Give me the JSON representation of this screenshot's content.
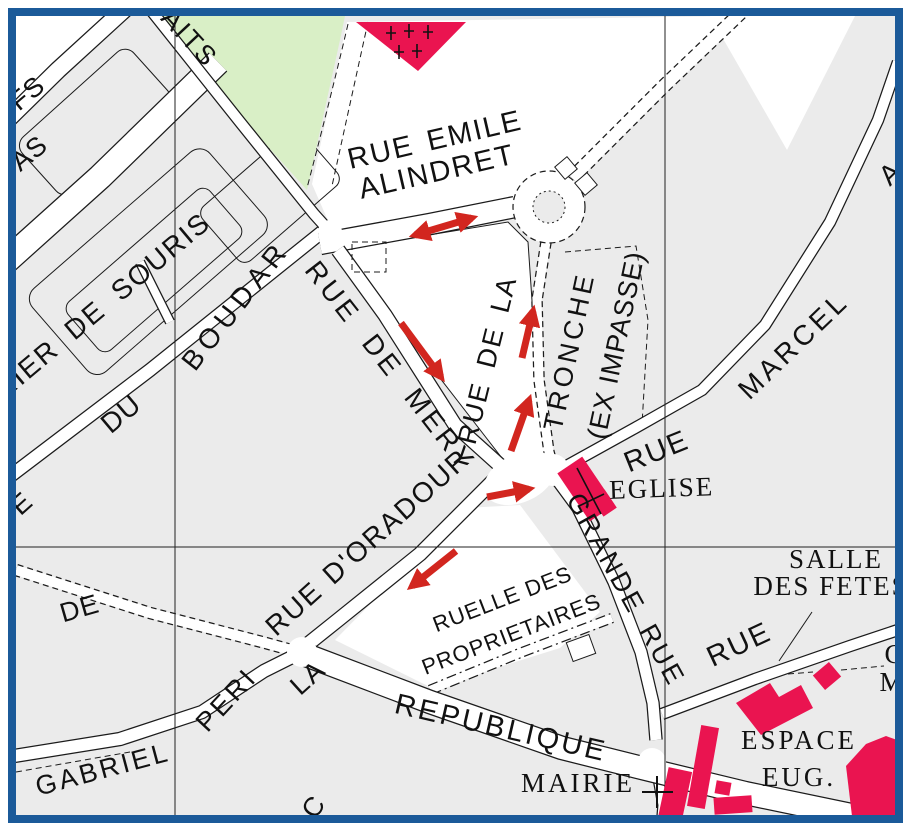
{
  "map": {
    "title": "street map extract with red circulation arrows",
    "canvas": {
      "width": 915,
      "height": 835
    },
    "colors": {
      "border": "#1b5a99",
      "margin": "#ffffff",
      "parcel": "#ebebeb",
      "road": "#ffffff",
      "line": "#1b1b1b",
      "green": "#d9efc6",
      "building": "#ea1450",
      "arrow": "#d2261f",
      "grid": "#222222",
      "text": "#111111"
    },
    "labels": [
      {
        "id": "fragment-aits",
        "text": "AITS",
        "x": 183,
        "y": 44,
        "r": 47,
        "s": 27,
        "ls": 2
      },
      {
        "id": "fragment-fs",
        "text": "FS",
        "x": 33,
        "y": 100,
        "r": -40,
        "s": 27,
        "ls": 1
      },
      {
        "id": "fragment-as",
        "text": "AS",
        "x": 35,
        "y": 160,
        "r": -40,
        "s": 27,
        "ls": 1
      },
      {
        "id": "rue-emile",
        "text": "RUE EMILE",
        "x": 437,
        "y": 149,
        "r": -13,
        "s": 29,
        "ls": 2,
        "ws": 4
      },
      {
        "id": "alindret",
        "text": "ALINDRET",
        "x": 439,
        "y": 181,
        "r": -13,
        "s": 29,
        "ls": 2
      },
      {
        "id": "rier-de-souris",
        "text": "RIER DE SOURIS",
        "x": 108,
        "y": 313,
        "r": -40,
        "s": 28,
        "ls": 2,
        "ws": 8
      },
      {
        "id": "du",
        "text": "DU",
        "x": 127,
        "y": 421,
        "r": -40,
        "s": 28,
        "ls": 1
      },
      {
        "id": "boudar",
        "text": "BOUDAR",
        "x": 243,
        "y": 311,
        "r": -52,
        "s": 28,
        "ls": 6
      },
      {
        "id": "rue-de-mery",
        "text": "RUE DE MERY",
        "x": 383,
        "y": 372,
        "r": 52,
        "s": 28,
        "ls": 4,
        "ws": 10
      },
      {
        "id": "rue-de-la",
        "text": "RUE DE LA",
        "x": 496,
        "y": 362,
        "r": -76,
        "s": 27,
        "ls": 2,
        "ws": 6
      },
      {
        "id": "tronche",
        "text": "TRONCHE",
        "x": 578,
        "y": 353,
        "r": -78,
        "s": 27,
        "ls": 4
      },
      {
        "id": "ex-impasse",
        "text": "(EX IMPASSE)",
        "x": 625,
        "y": 347,
        "r": -78,
        "s": 27,
        "ls": 1
      },
      {
        "id": "marcel",
        "text": "MARCEL",
        "x": 800,
        "y": 352,
        "r": -44,
        "s": 28,
        "ls": 4
      },
      {
        "id": "fragment-a",
        "text": "A",
        "x": 897,
        "y": 180,
        "r": -44,
        "s": 28,
        "ls": 1
      },
      {
        "id": "rue-marcel",
        "text": "RUE",
        "x": 660,
        "y": 460,
        "r": -22,
        "s": 29,
        "ls": 2
      },
      {
        "id": "eglise",
        "text": "EGLISE",
        "x": 662,
        "y": 497,
        "r": -2,
        "s": 27,
        "f": "serif",
        "ls": 2
      },
      {
        "id": "grande-rue",
        "text": "GRANDE RUE",
        "x": 618,
        "y": 594,
        "r": 61,
        "s": 27,
        "ls": 3,
        "ws": 6
      },
      {
        "id": "rue-d-oradour",
        "text": "RUE D'ORADOUR",
        "x": 374,
        "y": 549,
        "r": -42,
        "s": 28,
        "ls": 2,
        "ws": 2
      },
      {
        "id": "ruelle-des",
        "text": "RUELLE DES",
        "x": 505,
        "y": 606,
        "r": -21,
        "s": 22,
        "ls": 1
      },
      {
        "id": "proprietaires",
        "text": "PROPRIETAIRES",
        "x": 514,
        "y": 641,
        "r": -21,
        "s": 22,
        "ls": 1
      },
      {
        "id": "la",
        "text": "LA",
        "x": 314,
        "y": 684,
        "r": -42,
        "s": 27,
        "ls": 2
      },
      {
        "id": "peri",
        "text": "PERI",
        "x": 233,
        "y": 706,
        "r": -47,
        "s": 27,
        "ls": 3
      },
      {
        "id": "gabriel",
        "text": "GABRIEL",
        "x": 105,
        "y": 778,
        "r": -15,
        "s": 27,
        "ls": 3
      },
      {
        "id": "de",
        "text": "DE",
        "x": 82,
        "y": 617,
        "r": -16,
        "s": 27,
        "ls": 1
      },
      {
        "id": "republique",
        "text": "REPUBLIQUE",
        "x": 499,
        "y": 737,
        "r": 13,
        "s": 29,
        "ls": 3
      },
      {
        "id": "mairie",
        "text": "MAIRIE",
        "x": 578,
        "y": 792,
        "r": 0,
        "s": 27,
        "f": "serif",
        "ls": 3
      },
      {
        "id": "salle",
        "text": "SALLE",
        "x": 836,
        "y": 568,
        "r": 0,
        "s": 27,
        "f": "serif",
        "ls": 2
      },
      {
        "id": "des-fetes",
        "text": "DES FETES",
        "x": 831,
        "y": 595,
        "r": 0,
        "s": 27,
        "f": "serif",
        "ls": 2
      },
      {
        "id": "rue-salle-des-fetes",
        "text": "RUE",
        "x": 743,
        "y": 653,
        "r": -25,
        "s": 29,
        "ls": 2
      },
      {
        "id": "espace",
        "text": "ESPACE",
        "x": 799,
        "y": 749,
        "r": 0,
        "s": 27,
        "f": "serif",
        "ls": 3
      },
      {
        "id": "eug",
        "text": "EUG.",
        "x": 799,
        "y": 786,
        "r": 0,
        "s": 27,
        "f": "serif",
        "ls": 3
      },
      {
        "id": "fragment-c",
        "text": "C",
        "x": 894,
        "y": 663,
        "r": 0,
        "s": 27,
        "f": "serif",
        "ls": 1
      },
      {
        "id": "fragment-m",
        "text": "M",
        "x": 892,
        "y": 691,
        "r": 0,
        "s": 27,
        "f": "serif",
        "ls": 1
      },
      {
        "id": "fragment-ue",
        "text": "UE",
        "x": 20,
        "y": 517,
        "r": -42,
        "s": 27,
        "ls": 1
      },
      {
        "id": "fragment-bottom",
        "text": "C",
        "x": 321,
        "y": 812,
        "r": -55,
        "s": 27,
        "ls": 1
      }
    ],
    "arrows": [
      {
        "id": "arrow-alindret-two-way",
        "x1": 415,
        "y1": 235,
        "x2": 472,
        "y2": 218,
        "double": true
      },
      {
        "id": "arrow-mery-down",
        "x1": 401,
        "y1": 323,
        "x2": 441,
        "y2": 377,
        "double": false
      },
      {
        "id": "arrow-tronche-up-1",
        "x1": 522,
        "y1": 358,
        "x2": 533,
        "y2": 311,
        "double": false
      },
      {
        "id": "arrow-tronche-up-2",
        "x1": 511,
        "y1": 451,
        "x2": 529,
        "y2": 400,
        "double": false
      },
      {
        "id": "arrow-junction-right",
        "x1": 487,
        "y1": 497,
        "x2": 529,
        "y2": 489,
        "double": false
      },
      {
        "id": "arrow-oradour-down-left",
        "x1": 456,
        "y1": 551,
        "x2": 412,
        "y2": 586,
        "double": false
      }
    ],
    "buildings": [
      {
        "name": "cemetery-triangle",
        "poly": "356,22 466,22 418,71"
      },
      {
        "name": "church",
        "rect": [
          586,
          489,
          30,
          58,
          -34
        ]
      },
      {
        "name": "church-annex",
        "rect": [
          604,
          503,
          16,
          22,
          -34
        ]
      },
      {
        "name": "small-diamond-building",
        "rect": [
          827,
          676,
          21,
          19,
          -40
        ]
      },
      {
        "name": "espace-main-building",
        "poly": "736,703 770,683 779,697 801,685 813,708 761,735"
      },
      {
        "name": "espace-bar-building",
        "rect": [
          703,
          767,
          18,
          82,
          10
        ]
      },
      {
        "name": "espace-foot-building",
        "rect": [
          733,
          805,
          38,
          17,
          -4
        ]
      },
      {
        "name": "espace-small-building",
        "rect": [
          723,
          788,
          15,
          13,
          10
        ]
      },
      {
        "name": "mairie-side-building",
        "rect": [
          675,
          795,
          24,
          52,
          12
        ]
      },
      {
        "name": "corner-large-building",
        "poly": "846,766 866,744 886,736 897,740 897,818 852,816"
      }
    ],
    "cemetery_crosses": [
      [
        391,
        33
      ],
      [
        409,
        31
      ],
      [
        428,
        32
      ],
      [
        399,
        52
      ],
      [
        417,
        51
      ]
    ],
    "church_cross_lines": [
      [
        577,
        468,
        601,
        514
      ],
      [
        579,
        506,
        604,
        494
      ]
    ],
    "mairie_cross_lines": [
      [
        657,
        776,
        657,
        808
      ],
      [
        642,
        792,
        673,
        792
      ]
    ],
    "grid_lines": [
      {
        "x1": 175,
        "y1": 16,
        "x2": 175,
        "y2": 815
      },
      {
        "x1": 665,
        "y1": 16,
        "x2": 665,
        "y2": 815
      },
      {
        "x1": 16,
        "y1": 547,
        "x2": 895,
        "y2": 547
      }
    ],
    "roundabout": {
      "cx": 549,
      "cy": 207,
      "r_outer": 36,
      "r_inner": 16
    }
  }
}
